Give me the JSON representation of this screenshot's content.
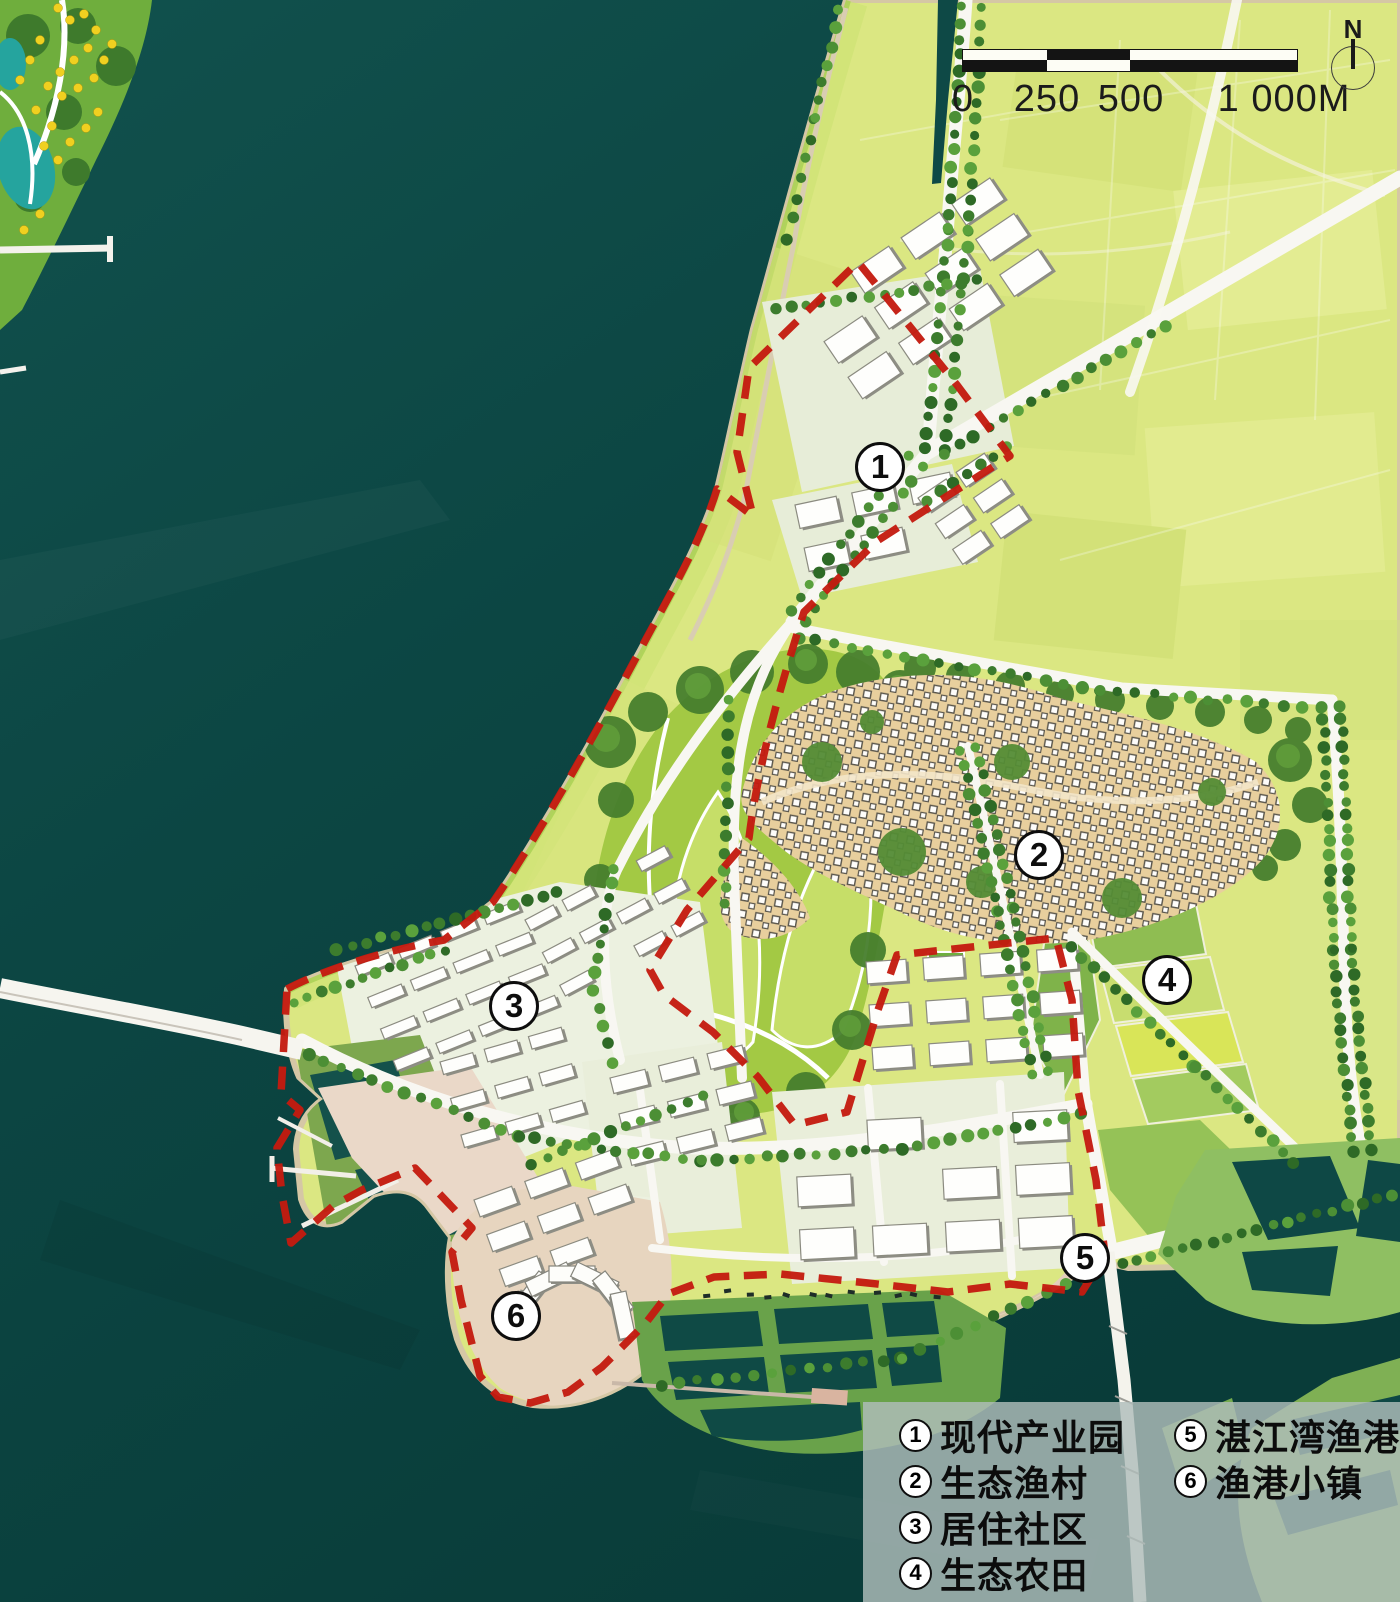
{
  "scale_bar": {
    "labels": [
      "0",
      "250",
      "500",
      "1 000M"
    ]
  },
  "north_arrow": {
    "label": "N"
  },
  "map_markers": [
    {
      "number": "1"
    },
    {
      "number": "2"
    },
    {
      "number": "3"
    },
    {
      "number": "4"
    },
    {
      "number": "5"
    },
    {
      "number": "6"
    }
  ],
  "legend": {
    "items": [
      {
        "number": "1",
        "label": "现代产业园"
      },
      {
        "number": "2",
        "label": "生态渔村"
      },
      {
        "number": "3",
        "label": "居住社区"
      },
      {
        "number": "4",
        "label": "生态农田"
      },
      {
        "number": "5",
        "label": "湛江湾渔港"
      },
      {
        "number": "6",
        "label": "渔港小镇"
      }
    ]
  },
  "colors": {
    "water": "#0d4643",
    "land": "#dbe782",
    "park": "#a3c944",
    "village": "#e8cf9d",
    "boundary": "#c41b10",
    "road": "#f8f7f2"
  }
}
